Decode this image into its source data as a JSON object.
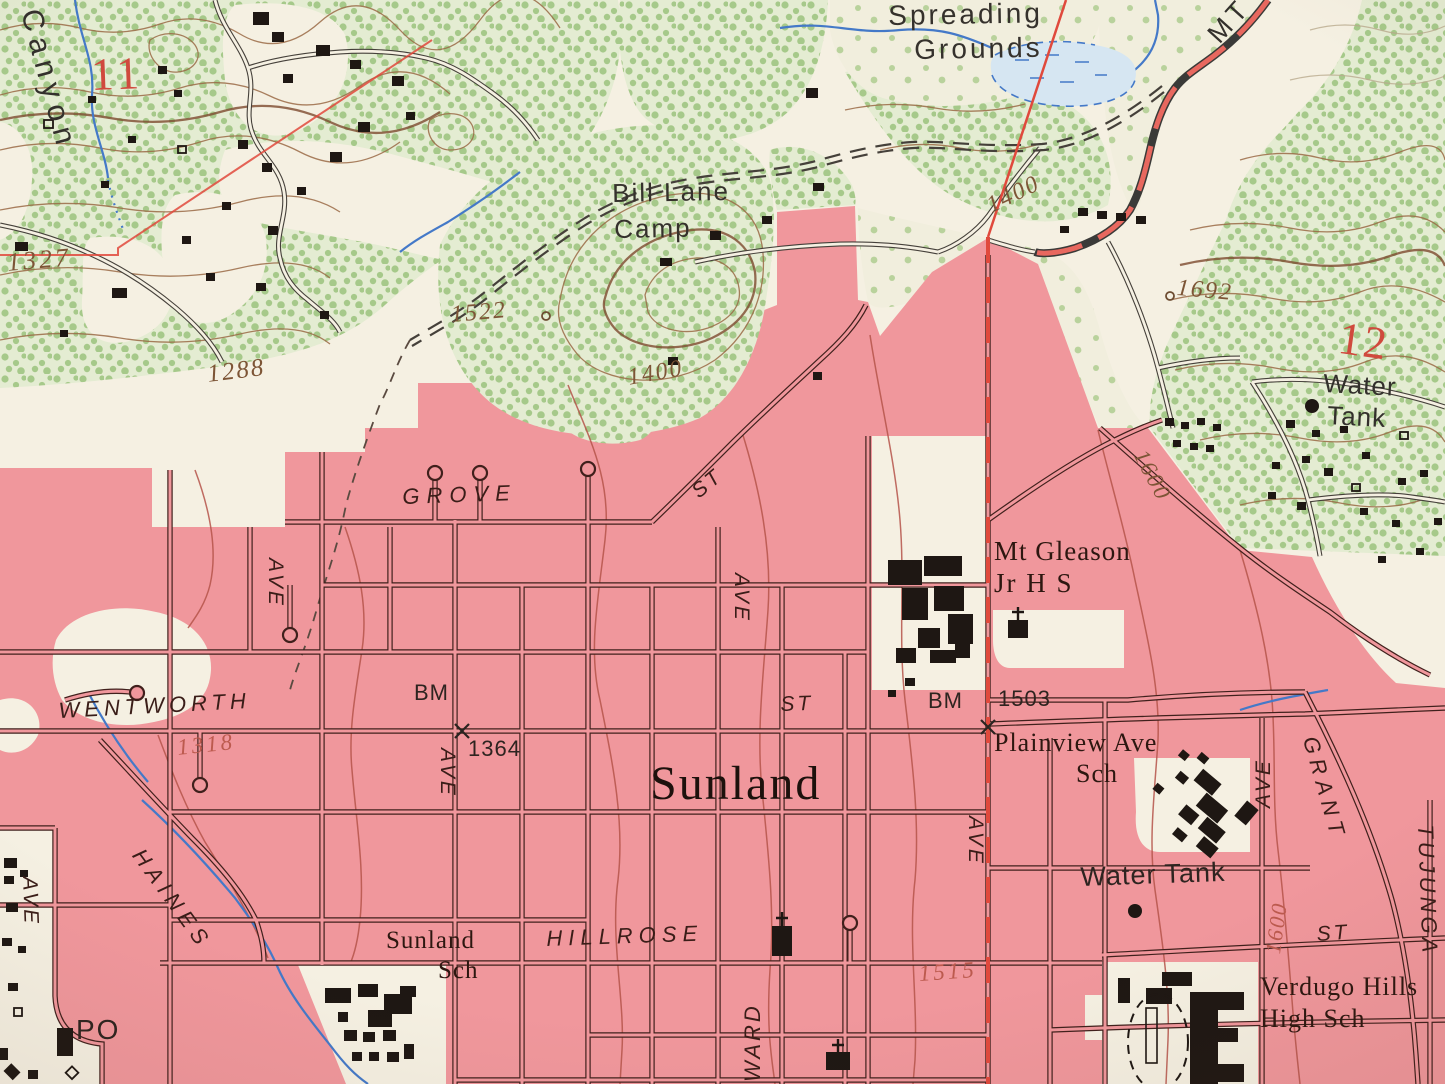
{
  "map": {
    "kind": "usgs-topographic-quad-photo",
    "place": "Sunland",
    "colors": {
      "paper": "#f5f0e2",
      "urban_tint": "#f0979c",
      "veg_base": "#e4ecd2",
      "veg_dot": "#a6c98a",
      "contour_brown": "#9a6a45",
      "contour_red": "#b5544a",
      "water_blue": "#4479c8",
      "road_red": "#e8685f",
      "boundary_red": "#e0493c",
      "ink": "#2e2823",
      "street_ink": "#40201c"
    },
    "features": {
      "place_names": [
        "Sunland",
        "Canyon",
        "Spreading Grounds",
        "Bill Lane Camp"
      ],
      "schools": [
        "Mt Gleason Jr H S",
        "Plainview Ave Sch",
        "Sunland Sch",
        "Verdugo Hills High Sch"
      ],
      "streets": [
        "GROVE ST",
        "WENTWORTH ST",
        "HILLROSE",
        "HAINES",
        "GRANT",
        "TUJUNGA",
        "WARD",
        "AVE",
        "MT"
      ],
      "benchmarks": [
        "BM 1364",
        "BM 1503"
      ],
      "spot_elevations": [
        "1327",
        "1522",
        "1692"
      ],
      "contour_elevations": [
        "1288",
        "1318",
        "1400",
        "1515",
        "1600"
      ],
      "section_numbers": [
        "11",
        "12"
      ],
      "other": [
        "Water Tank",
        "Water Tank",
        "PO"
      ]
    },
    "labels": [
      {
        "id": "canyon",
        "text": "Canyon",
        "x": 44,
        "y": 6,
        "size": 30,
        "rot": 75,
        "color": "#33302c",
        "font": "sans",
        "italic": false,
        "spacing": 7
      },
      {
        "id": "section-11",
        "text": "11",
        "x": 90,
        "y": 52,
        "size": 46,
        "rot": -2,
        "color": "#d0493d",
        "font": "serif",
        "italic": false,
        "spacing": 4
      },
      {
        "id": "spot-1327",
        "text": "1327",
        "x": 6,
        "y": 250,
        "size": 26,
        "rot": -5,
        "color": "#7d5536",
        "font": "serif",
        "italic": true,
        "spacing": 3
      },
      {
        "id": "spreading",
        "text": "Spreading",
        "x": 888,
        "y": 2,
        "size": 28,
        "rot": -1,
        "color": "#35312c",
        "font": "sans",
        "italic": false,
        "spacing": 3
      },
      {
        "id": "grounds",
        "text": "Grounds",
        "x": 914,
        "y": 36,
        "size": 28,
        "rot": -1,
        "color": "#35312c",
        "font": "sans",
        "italic": false,
        "spacing": 3
      },
      {
        "id": "bill-lane",
        "text": "Bill Lane",
        "x": 612,
        "y": 180,
        "size": 26,
        "rot": -1,
        "color": "#35312c",
        "font": "sans",
        "italic": false,
        "spacing": 2
      },
      {
        "id": "camp",
        "text": "Camp",
        "x": 614,
        "y": 216,
        "size": 26,
        "rot": -1,
        "color": "#35312c",
        "font": "sans",
        "italic": false,
        "spacing": 2
      },
      {
        "id": "spot-1522",
        "text": "1522",
        "x": 450,
        "y": 303,
        "size": 24,
        "rot": -5,
        "color": "#7d5536",
        "font": "serif",
        "italic": true,
        "spacing": 2
      },
      {
        "id": "contour-1400-a",
        "text": "1400",
        "x": 983,
        "y": 196,
        "size": 24,
        "rot": -26,
        "color": "#7d5536",
        "font": "serif",
        "italic": true,
        "spacing": 2
      },
      {
        "id": "contour-1400-b",
        "text": "1400",
        "x": 626,
        "y": 366,
        "size": 24,
        "rot": -10,
        "color": "#7d5536",
        "font": "serif",
        "italic": true,
        "spacing": 2
      },
      {
        "id": "road-mt",
        "text": "MT",
        "x": 1203,
        "y": 30,
        "size": 27,
        "rot": -48,
        "color": "#33302c",
        "font": "sans",
        "italic": false,
        "spacing": 5
      },
      {
        "id": "spot-1692",
        "text": "1692",
        "x": 1178,
        "y": 276,
        "size": 24,
        "rot": 5,
        "color": "#7d5536",
        "font": "serif",
        "italic": true,
        "spacing": 2
      },
      {
        "id": "section-12",
        "text": "12",
        "x": 1342,
        "y": 315,
        "size": 46,
        "rot": 8,
        "color": "#d0493d",
        "font": "serif",
        "italic": false,
        "spacing": 2
      },
      {
        "id": "water-tank-1a",
        "text": "Water",
        "x": 1324,
        "y": 370,
        "size": 26,
        "rot": 3,
        "color": "#33302c",
        "font": "sans",
        "italic": false,
        "spacing": 1
      },
      {
        "id": "water-tank-1b",
        "text": "Tank",
        "x": 1328,
        "y": 402,
        "size": 26,
        "rot": 3,
        "color": "#33302c",
        "font": "sans",
        "italic": false,
        "spacing": 1
      },
      {
        "id": "contour-1600-a",
        "text": "1600",
        "x": 1150,
        "y": 446,
        "size": 23,
        "rot": 62,
        "color": "#7d5536",
        "font": "serif",
        "italic": true,
        "spacing": 2
      },
      {
        "id": "contour-1288",
        "text": "1288",
        "x": 206,
        "y": 362,
        "size": 25,
        "rot": -7,
        "color": "#7d5536",
        "font": "serif",
        "italic": true,
        "spacing": 2
      },
      {
        "id": "street-grove",
        "text": "GROVE",
        "x": 402,
        "y": 486,
        "size": 22,
        "rot": -2,
        "color": "#3a1d18",
        "font": "sans",
        "italic": true,
        "spacing": 7
      },
      {
        "id": "street-grove-st",
        "text": "ST",
        "x": 688,
        "y": 486,
        "size": 21,
        "rot": -40,
        "color": "#3a1d18",
        "font": "sans",
        "italic": true,
        "spacing": 3
      },
      {
        "id": "street-ave-1",
        "text": "AVE",
        "x": 286,
        "y": 558,
        "size": 21,
        "rot": 90,
        "color": "#3a1d18",
        "font": "sans",
        "italic": true,
        "spacing": 3
      },
      {
        "id": "street-wentworth",
        "text": "WENTWORTH",
        "x": 58,
        "y": 700,
        "size": 22,
        "rot": -3,
        "color": "#3a1d18",
        "font": "sans",
        "italic": true,
        "spacing": 5
      },
      {
        "id": "contour-1318",
        "text": "1318",
        "x": 176,
        "y": 736,
        "size": 23,
        "rot": -6,
        "color": "#bc5a4e",
        "font": "serif",
        "italic": true,
        "spacing": 3
      },
      {
        "id": "bm-1364-bm",
        "text": "BM",
        "x": 414,
        "y": 682,
        "size": 22,
        "rot": 0,
        "color": "#2e2420",
        "font": "sans",
        "italic": false,
        "spacing": 1
      },
      {
        "id": "bm-1364-val",
        "text": "1364",
        "x": 468,
        "y": 738,
        "size": 22,
        "rot": 0,
        "color": "#2e2420",
        "font": "sans",
        "italic": false,
        "spacing": 1
      },
      {
        "id": "street-ave-2",
        "text": "AVE",
        "x": 458,
        "y": 748,
        "size": 21,
        "rot": 90,
        "color": "#3a1d18",
        "font": "sans",
        "italic": true,
        "spacing": 3
      },
      {
        "id": "place-sunland",
        "text": "Sunland",
        "x": 650,
        "y": 760,
        "size": 48,
        "rot": 0,
        "color": "#1d110c",
        "font": "serif",
        "italic": false,
        "spacing": 2
      },
      {
        "id": "street-wentworth-st",
        "text": "ST",
        "x": 780,
        "y": 694,
        "size": 21,
        "rot": -2,
        "color": "#3a1d18",
        "font": "sans",
        "italic": true,
        "spacing": 3
      },
      {
        "id": "bm-1503-bm",
        "text": "BM",
        "x": 928,
        "y": 690,
        "size": 22,
        "rot": 0,
        "color": "#2e2420",
        "font": "sans",
        "italic": false,
        "spacing": 1
      },
      {
        "id": "bm-1503-val",
        "text": "1503",
        "x": 998,
        "y": 688,
        "size": 22,
        "rot": 0,
        "color": "#2e2420",
        "font": "sans",
        "italic": false,
        "spacing": 1
      },
      {
        "id": "school-mt-gleason-1",
        "text": "Mt Gleason",
        "x": 994,
        "y": 538,
        "size": 27,
        "rot": 0,
        "color": "#2d1710",
        "font": "serif",
        "italic": false,
        "spacing": 1
      },
      {
        "id": "school-mt-gleason-2",
        "text": "Jr H S",
        "x": 994,
        "y": 570,
        "size": 27,
        "rot": 0,
        "color": "#2d1710",
        "font": "serif",
        "italic": false,
        "spacing": 2
      },
      {
        "id": "street-ave-3",
        "text": "AVE",
        "x": 752,
        "y": 573,
        "size": 21,
        "rot": 90,
        "color": "#3a1d18",
        "font": "sans",
        "italic": true,
        "spacing": 3
      },
      {
        "id": "school-plainview-1",
        "text": "Plainview Ave",
        "x": 994,
        "y": 730,
        "size": 26,
        "rot": 0,
        "color": "#2d1710",
        "font": "serif",
        "italic": false,
        "spacing": 1
      },
      {
        "id": "school-plainview-2",
        "text": "Sch",
        "x": 1076,
        "y": 761,
        "size": 26,
        "rot": 0,
        "color": "#2d1710",
        "font": "serif",
        "italic": false,
        "spacing": 1
      },
      {
        "id": "street-grant",
        "text": "GRANT",
        "x": 1320,
        "y": 734,
        "size": 22,
        "rot": 74,
        "color": "#3a1d18",
        "font": "sans",
        "italic": true,
        "spacing": 6
      },
      {
        "id": "street-ave-4",
        "text": "AVE",
        "x": 1253,
        "y": 808,
        "size": 21,
        "rot": -90,
        "color": "#3a1d18",
        "font": "sans",
        "italic": true,
        "spacing": 3
      },
      {
        "id": "street-tujunga",
        "text": "TUJUNGA",
        "x": 1436,
        "y": 824,
        "size": 22,
        "rot": 88,
        "color": "#3a1d18",
        "font": "sans",
        "italic": true,
        "spacing": 4
      },
      {
        "id": "water-tank-2",
        "text": "Water Tank",
        "x": 1080,
        "y": 864,
        "size": 27,
        "rot": -2,
        "color": "#2e2420",
        "font": "sans",
        "italic": false,
        "spacing": 1
      },
      {
        "id": "contour-1600-b",
        "text": "1600",
        "x": 1262,
        "y": 952,
        "size": 22,
        "rot": -82,
        "color": "#bc5a4e",
        "font": "serif",
        "italic": true,
        "spacing": 2
      },
      {
        "id": "street-st-grant",
        "text": "ST",
        "x": 1316,
        "y": 924,
        "size": 21,
        "rot": -4,
        "color": "#3a1d18",
        "font": "sans",
        "italic": true,
        "spacing": 3
      },
      {
        "id": "street-haines",
        "text": "HAINES",
        "x": 146,
        "y": 845,
        "size": 22,
        "rot": 54,
        "color": "#3a1d18",
        "font": "sans",
        "italic": true,
        "spacing": 6
      },
      {
        "id": "street-ave-5",
        "text": "AVE",
        "x": 40,
        "y": 876,
        "size": 21,
        "rot": 88,
        "color": "#3a1d18",
        "font": "sans",
        "italic": true,
        "spacing": 3
      },
      {
        "id": "po",
        "text": "PO",
        "x": 76,
        "y": 1016,
        "size": 28,
        "rot": 0,
        "color": "#2e2420",
        "font": "sans",
        "italic": false,
        "spacing": 2
      },
      {
        "id": "school-sunland-1",
        "text": "Sunland",
        "x": 386,
        "y": 928,
        "size": 25,
        "rot": 0,
        "color": "#2d1710",
        "font": "serif",
        "italic": false,
        "spacing": 1
      },
      {
        "id": "school-sunland-2",
        "text": "Sch",
        "x": 438,
        "y": 958,
        "size": 25,
        "rot": 0,
        "color": "#2d1710",
        "font": "serif",
        "italic": false,
        "spacing": 1
      },
      {
        "id": "street-hillrose",
        "text": "HILLROSE",
        "x": 546,
        "y": 928,
        "size": 22,
        "rot": -2,
        "color": "#3a1d18",
        "font": "sans",
        "italic": true,
        "spacing": 6
      },
      {
        "id": "contour-1515",
        "text": "1515",
        "x": 918,
        "y": 962,
        "size": 23,
        "rot": -4,
        "color": "#bc5a4e",
        "font": "serif",
        "italic": true,
        "spacing": 3
      },
      {
        "id": "street-ward",
        "text": "WARD",
        "x": 742,
        "y": 1082,
        "size": 22,
        "rot": -90,
        "color": "#3a1d18",
        "font": "sans",
        "italic": true,
        "spacing": 3
      },
      {
        "id": "school-verdugo-1",
        "text": "Verdugo Hills",
        "x": 1260,
        "y": 974,
        "size": 26,
        "rot": 0,
        "color": "#2d1710",
        "font": "serif",
        "italic": false,
        "spacing": 1
      },
      {
        "id": "school-verdugo-2",
        "text": "High Sch",
        "x": 1260,
        "y": 1006,
        "size": 26,
        "rot": 0,
        "color": "#2d1710",
        "font": "serif",
        "italic": false,
        "spacing": 1
      },
      {
        "id": "street-ave-6",
        "text": "AVE",
        "x": 986,
        "y": 816,
        "size": 21,
        "rot": 90,
        "color": "#3a1d18",
        "font": "sans",
        "italic": true,
        "spacing": 3
      }
    ]
  }
}
